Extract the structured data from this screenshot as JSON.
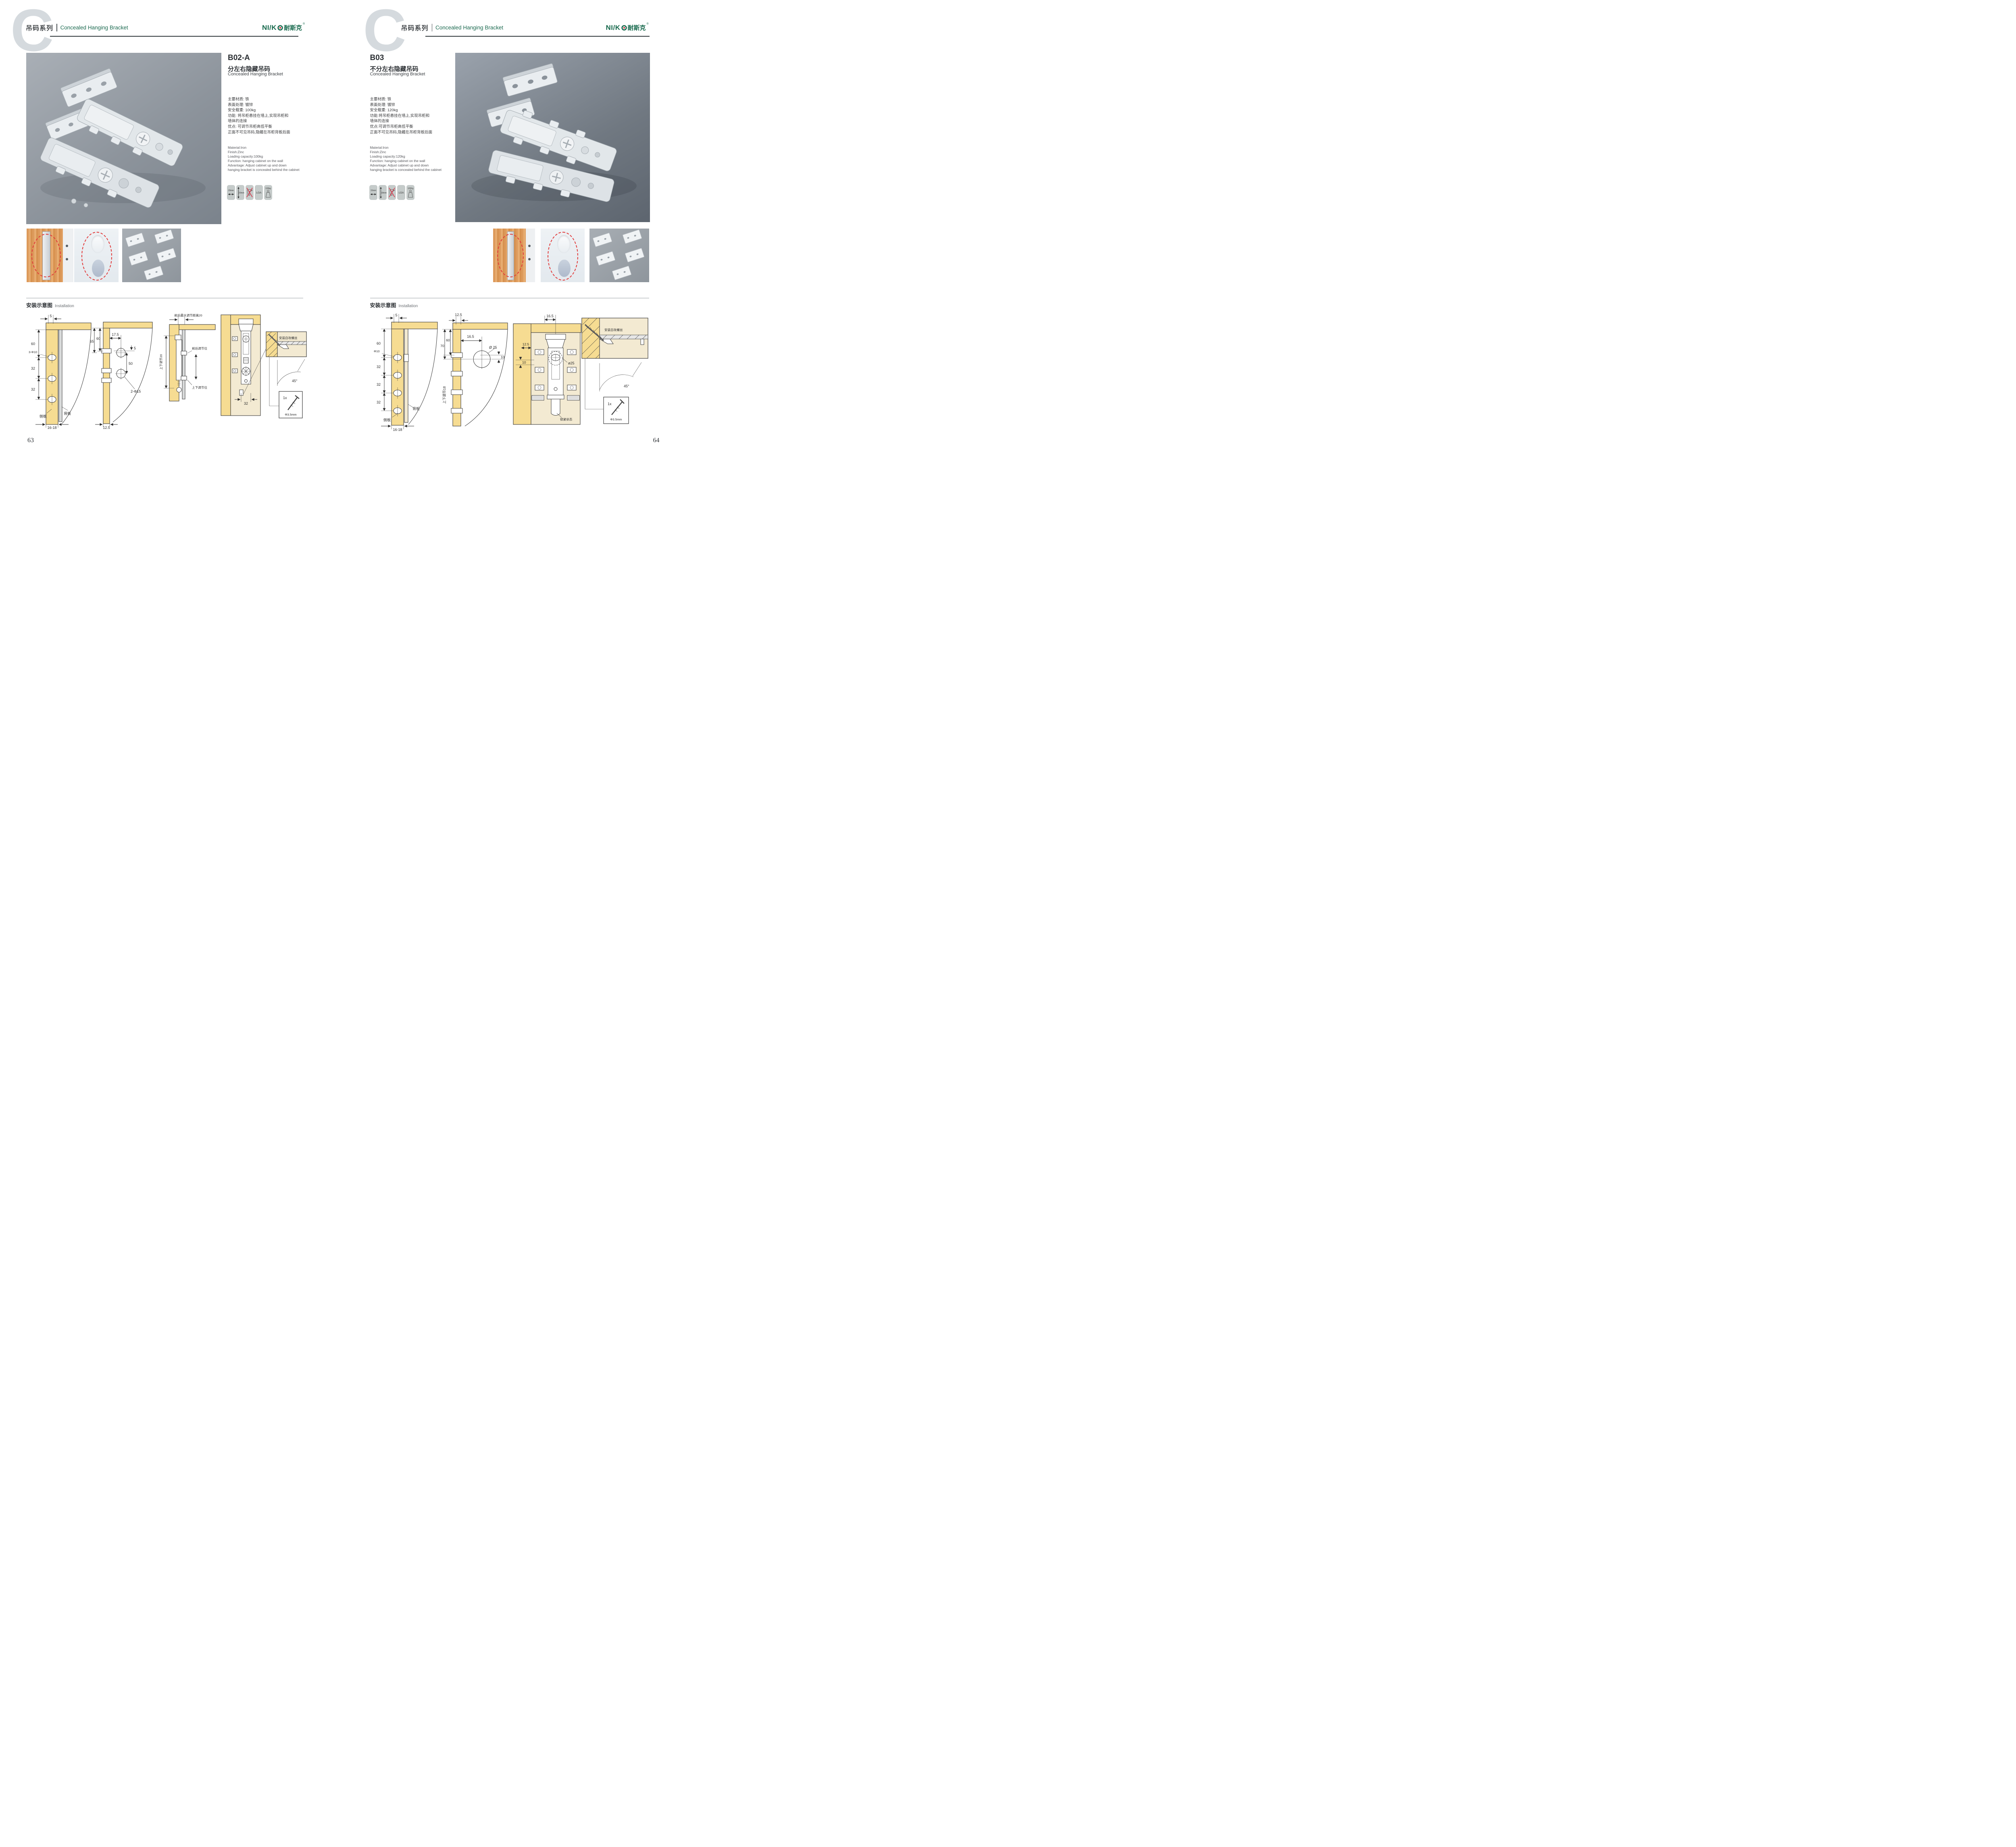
{
  "colors": {
    "brand_green": "#15684b",
    "accent_red": "#d93a3a",
    "panel_yellow": "#f6dc92",
    "photo_gray": "#8b929a"
  },
  "brand": {
    "bg_letter": "C",
    "latin": "NI/K",
    "cjk": "耐斯克",
    "reg": "®"
  },
  "left": {
    "page_number": "63",
    "header": {
      "series_cn": "吊码系列",
      "series_en": "Concealed Hanging Bracket"
    },
    "product": {
      "code": "B02-A",
      "title_cn": "分左右隐藏吊码",
      "title_en": "Concealed Hanging Bracket",
      "specs_cn": [
        "主要材质: 铁",
        "表面处理: 镀锌",
        "安全载重: 100kg",
        "功能: 将吊柜悬挂在墙上,实现吊柜和",
        "墙体的连接",
        "优点: 可调节吊柜高低平衡",
        "正面不可见吊码,隐藏在吊柜背板后面"
      ],
      "specs_en": [
        "Material:Iron",
        "Finish:Zinc",
        "Loading capacity:100kg",
        "Function: hanging cabinet on the wall",
        "Advantage: Adjust cabinet up and down",
        "hanging bracket is concealed behind the cabinet"
      ]
    },
    "icons": {
      "width": "20mm",
      "height": "20mm",
      "cert": "LGA",
      "load": "100kg"
    },
    "install": {
      "cn": "安装示意图",
      "en": "Installation"
    },
    "d1": {
      "t5": "5",
      "t60": "60",
      "hole": "3-Φ10",
      "t32a": "32",
      "t32b": "32",
      "side": "侧板",
      "back": "背板",
      "bot": "16-18"
    },
    "d2": {
      "t65": "65",
      "t60": "60",
      "t175": "17.5",
      "t5": "5",
      "t50": "50",
      "hole": "2-Φ15",
      "t125": "12.5"
    },
    "d3": {
      "top": "前后最大调节距离20",
      "vert": "上下调节20",
      "fb": "前后调节位",
      "ud": "上下调节位"
    },
    "d4": {
      "t32": "32",
      "screw": "安装自攻螺丝",
      "deg": "45°",
      "qty": "1x",
      "dia": "Φ3.5mm"
    }
  },
  "right": {
    "page_number": "64",
    "header": {
      "series_cn": "吊码系列",
      "series_en": "Concealed Hanging Bracket"
    },
    "product": {
      "code": "B03",
      "title_cn": "不分左右隐藏吊码",
      "title_en": "Concealed Hanging Bracket",
      "specs_cn": [
        "主要材质: 铁",
        "表面处理: 镀锌",
        "安全载重: 120kg",
        "功能:将吊柜悬挂在墙上,实现吊柜和",
        "墙体的连接",
        "优点:可调节吊柜高低平衡",
        "正面不可见吊码,隐藏在吊柜背板后面"
      ],
      "specs_en": [
        "Material:Iron",
        "Finish:Zinc",
        "Loading capacity:120kg",
        "Function: hanging cabinet on the wall",
        "Advantage: Adjust cabinet up and down",
        "hanging bracket is concealed behind the cabinet"
      ]
    },
    "icons": {
      "width": "15mm",
      "height": "18mm",
      "cert": "LGA",
      "load": "120Kg"
    },
    "install": {
      "cn": "安装示意图",
      "en": "Installation"
    },
    "d1": {
      "t5": "5",
      "t60": "60",
      "hole": "Φ10",
      "t32a": "32",
      "t32b": "32",
      "t32c": "32",
      "back": "背板",
      "side": "侧板",
      "bot": "16-18"
    },
    "d2": {
      "t125": "12.5",
      "t70": "70",
      "t60": "60",
      "t165": "16.5",
      "dia": "Ø 25",
      "t10": "10",
      "vert": "上下调节18"
    },
    "d3": {
      "t165": "16.5",
      "t125": "12.5",
      "t10": "10",
      "dia": "ø25",
      "lock": "锁紧状态"
    },
    "d4": {
      "screw": "安装自攻螺丝",
      "deg": "45°",
      "qty": "1x",
      "dia": "Φ3.5mm"
    }
  }
}
